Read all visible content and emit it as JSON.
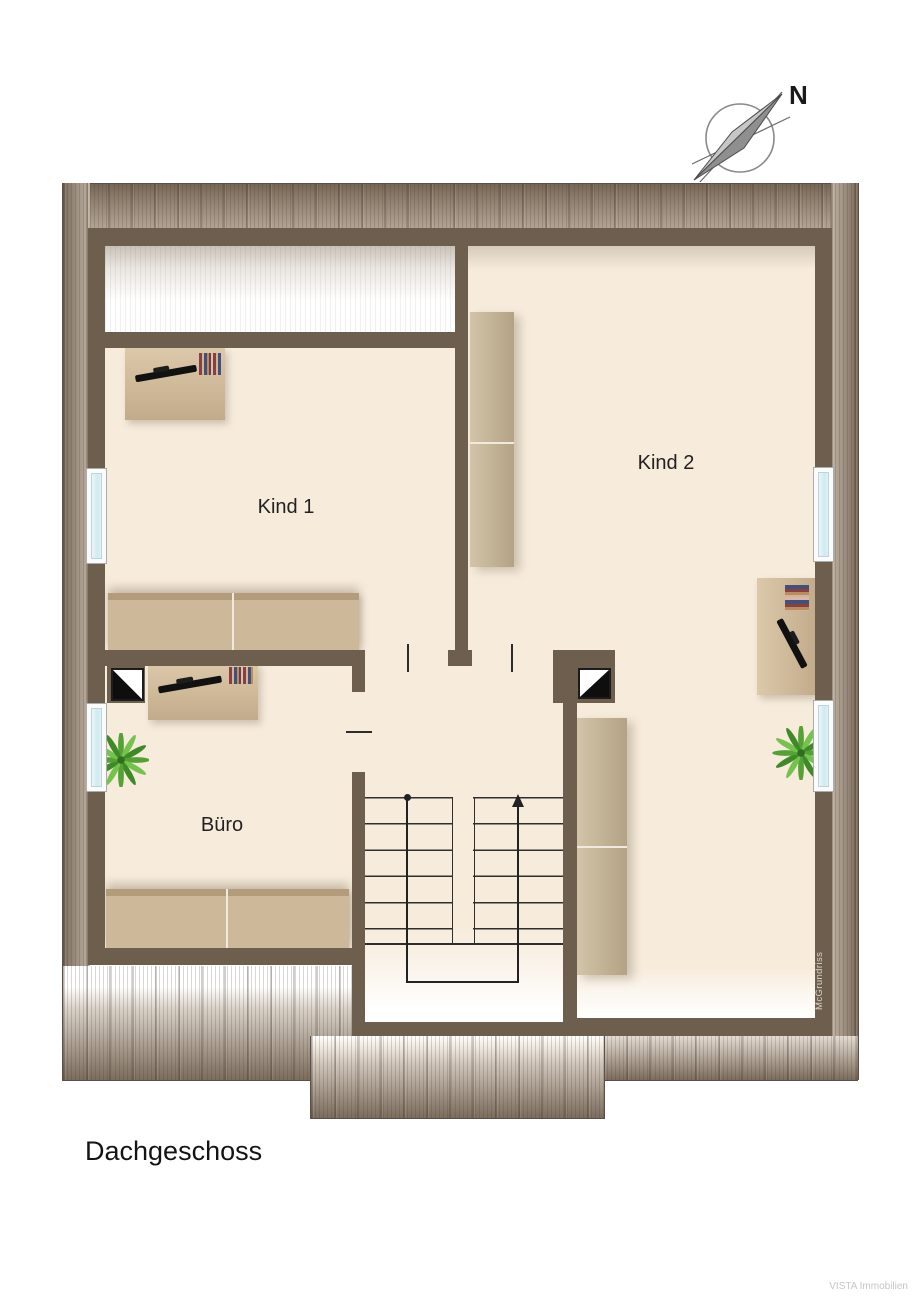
{
  "title": "Dachgeschoss",
  "compass": {
    "north_label": "N"
  },
  "rooms": [
    {
      "id": "kind1",
      "label": "Kind 1"
    },
    {
      "id": "kind2",
      "label": "Kind 2"
    },
    {
      "id": "buero",
      "label": "Büro"
    }
  ],
  "branding": {
    "plan_credit_vertical": "McGrundriss",
    "watermark": "VISTA Immobilien"
  },
  "symbols": {
    "furniture": [
      "bed",
      "desk",
      "office-chair",
      "wardrobe",
      "sideboard",
      "nightstand",
      "potted-plant",
      "staircase",
      "chimney",
      "window",
      "compass-rose"
    ]
  },
  "colors": {
    "wall": "#6d5e4d",
    "floor": "#f7ecdc",
    "roof_hatch_dark": "#7b6c5c",
    "duvet_purple": "#9b72ad",
    "wood_light": "#cdb795",
    "window_glass": "#cfe9f1",
    "chair_gray": "#45454a",
    "plant_green": "#55a234"
  }
}
